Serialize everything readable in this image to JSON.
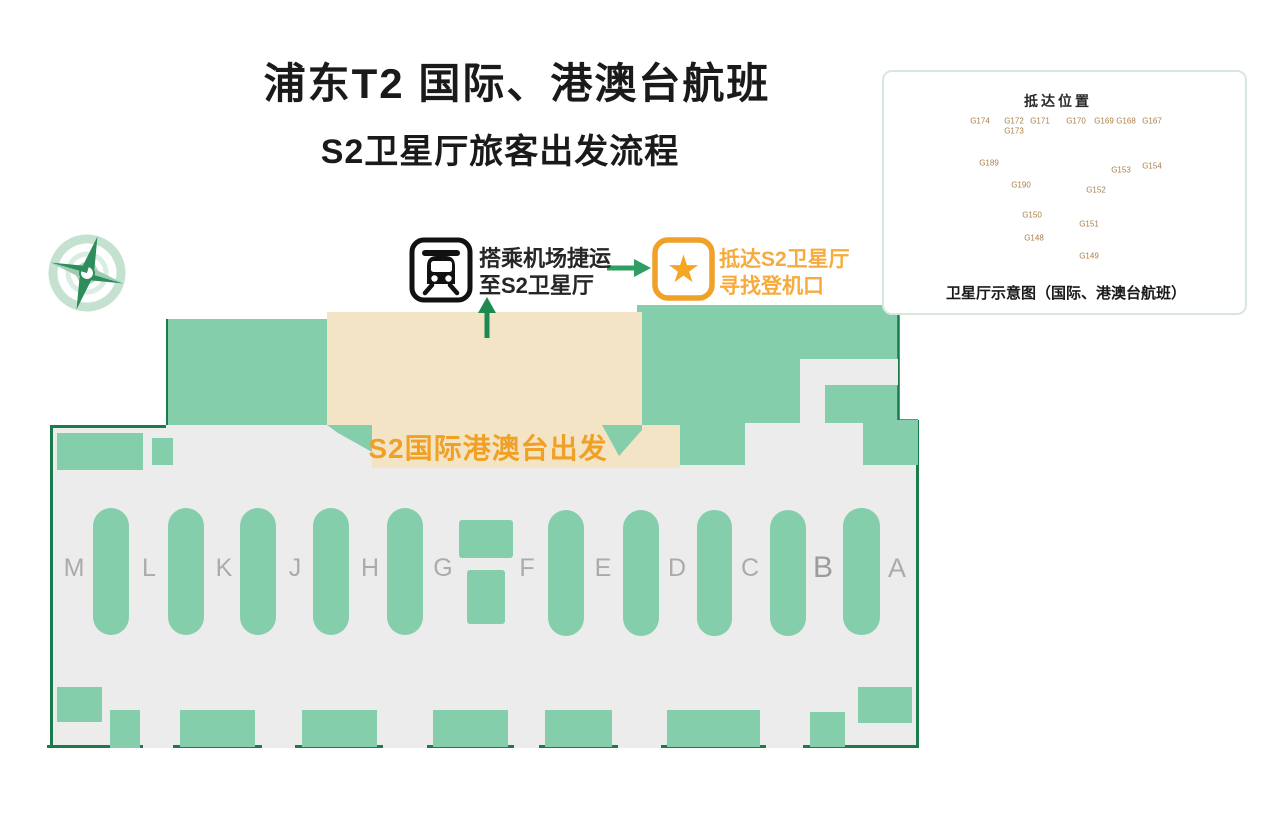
{
  "page": {
    "title": "浦东T2  国际、港澳台航班",
    "subtitle": "S2卫星厅旅客出发流程"
  },
  "flow": {
    "step1_line1": "搭乘机场捷运",
    "step1_line2": "至S2卫星厅",
    "step2_line1": "抵达S2卫星厅",
    "step2_line2": "寻找登机口"
  },
  "terminal": {
    "departure_label": "S2国际港澳台出发",
    "checkin_islands": [
      "M",
      "L",
      "K",
      "J",
      "H",
      "G",
      "F",
      "E",
      "D",
      "C",
      "B",
      "A"
    ],
    "security_marks": {
      "row1_count": 24,
      "row2_count": 18,
      "single_count": 1,
      "right_ticks": 9
    }
  },
  "compass": {
    "n": "N",
    "e": "E",
    "s": "S",
    "w": "W"
  },
  "inset": {
    "title": "抵达位置",
    "caption": "卫星厅示意图（国际、港澳台航班）",
    "finger_count": 26,
    "gates": [
      "G174",
      "G172",
      "G173",
      "G171",
      "G170",
      "G169",
      "G168",
      "G167",
      "G189",
      "G153",
      "G154",
      "G190",
      "G152",
      "G150",
      "G151",
      "G148",
      "G149"
    ]
  },
  "colors": {
    "teal": "#85ceac",
    "dark_green": "#1b7b4c",
    "gray": "#ececec",
    "beige": "#f4e4c6",
    "orange": "#f0a125",
    "tan": "#e0bb8a",
    "tan_dark": "#c99b5f"
  }
}
